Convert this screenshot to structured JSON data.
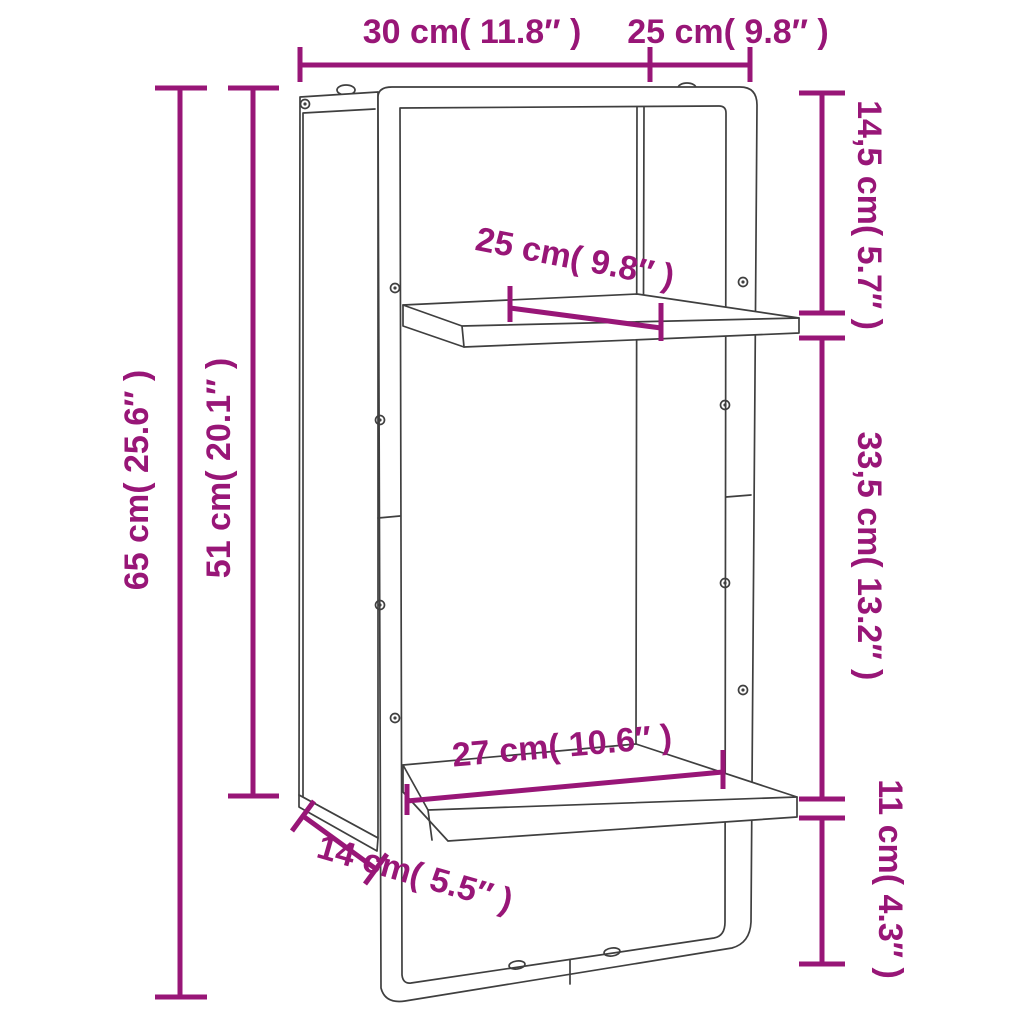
{
  "diagram": {
    "kind": "product-dimension-diagram",
    "subject": "wall shelf with two boards, side panel and metal frame",
    "accent_color": "#981677",
    "outline_color": "#3f3f3f",
    "background_color": "#ffffff",
    "labels": {
      "top_width": "30 cm( 11.8″ )",
      "top_depth": "25 cm( 9.8″ )",
      "overall_height": "65 cm( 25.6″ )",
      "panel_height": "51 cm( 20.1″ )",
      "top_to_upper_shelf": "14,5 cm( 5.7″ )",
      "shelf_spacing": "33,5 cm( 13.2″ )",
      "lower_shelf_to_bottom": "11 cm( 4.3″ )",
      "shelf_depth": "25 cm( 9.8″ )",
      "lower_shelf_width": "27 cm( 10.6″ )",
      "panel_depth": "14 cm( 5.5″ )"
    }
  }
}
